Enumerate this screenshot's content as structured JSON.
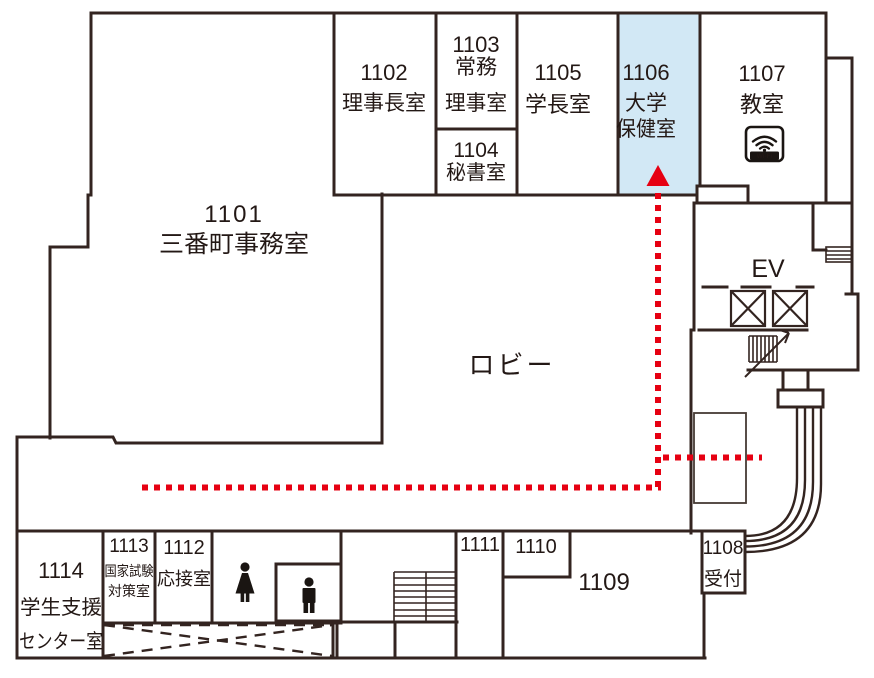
{
  "colors": {
    "wall": "#332420",
    "text": "#231815",
    "highlight_room": "#d2e8f5",
    "route": "#e60012"
  },
  "rooms": {
    "r1101": {
      "no": "1101",
      "name": "三番町事務室"
    },
    "r1102": {
      "no": "1102",
      "name": "理事長室"
    },
    "r1103": {
      "no": "1103",
      "name_line1": "常務",
      "name_line2": "理事室"
    },
    "r1104": {
      "no": "1104",
      "name": "秘書室"
    },
    "r1105": {
      "no": "1105",
      "name": "学長室"
    },
    "r1106": {
      "no": "1106",
      "name_line1": "大学",
      "name_line2": "保健室",
      "highlighted": true
    },
    "r1107": {
      "no": "1107",
      "name": "教室",
      "has_wifi": true
    },
    "r1108": {
      "no": "1108",
      "name": "受付"
    },
    "r1109": {
      "no": "1109"
    },
    "r1110": {
      "no": "1110"
    },
    "r1111": {
      "no": "1111"
    },
    "r1112": {
      "no": "1112",
      "name": "応接室"
    },
    "r1113": {
      "no": "1113",
      "name_line1": "国家試験",
      "name_line2": "対策室"
    },
    "r1114": {
      "no": "1114",
      "name_line1": "学生支援",
      "name_line2": "センター室"
    }
  },
  "areas": {
    "lobby": "ロビー",
    "elevator": "EV"
  },
  "icons": {
    "wifi": "Wi-Fi"
  }
}
